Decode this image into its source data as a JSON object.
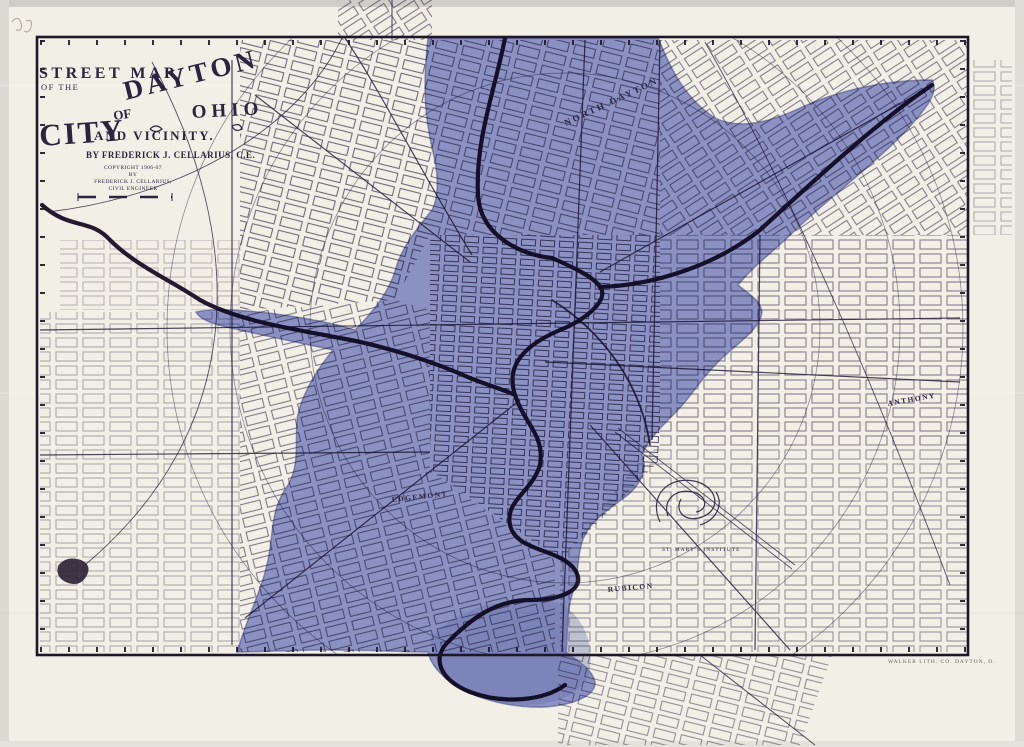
{
  "title_block": {
    "header": "STREET MAP",
    "subheader": "OF THE",
    "title_city": "CITY",
    "title_of": "OF",
    "title_dayton": "DAYTON",
    "title_state": "OHIO",
    "title_vicinity": "AND VICINITY.",
    "byline": "BY FREDERICK J. CELLARIUS, C.E.",
    "copyright": [
      "COPYRIGHT 1906-07",
      "BY",
      "FREDERICK J. CELLARIUS,",
      "CIVIL ENGINEER"
    ]
  },
  "map_labels": {
    "north_dayton": "NORTH DAYTON",
    "edgemont": "EDGEMONT",
    "rubicon": "RUBICON",
    "anthony": "ANTHONY",
    "st_marys": "ST. MARY'S INSTITUTE"
  },
  "printer_credit": "WALKER LITH. CO. DAYTON, O.",
  "colors": {
    "paper": "#f4f1e7",
    "ink": "#2c2340",
    "flood_overlay": "#7f8ad0",
    "flood_deep": "#6a73bb",
    "frame": "#1d1727",
    "river": "#241a30"
  }
}
